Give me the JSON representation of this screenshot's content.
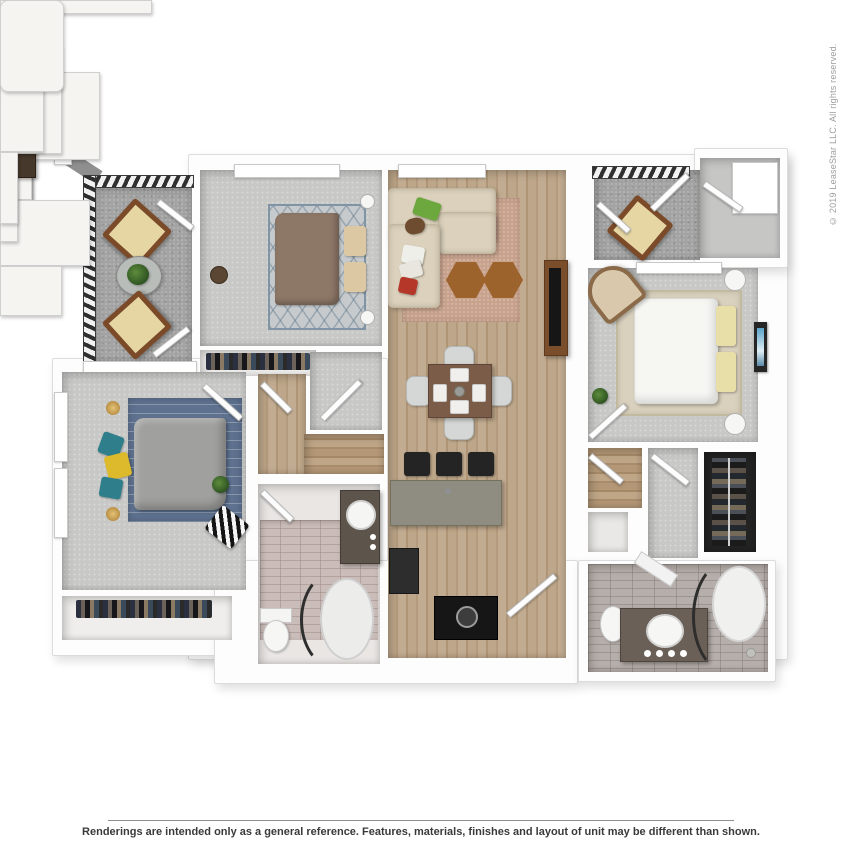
{
  "watermark": {
    "text": "© 2019 LeaseStar LLC. All rights reserved.",
    "color": "#9e9e9e"
  },
  "footer": {
    "disclaimer": "Renderings are intended only as a general reference. Features, materials, finishes and layout of unit may be different than shown.",
    "rule_color": "#8f8f8f",
    "text_color": "#3a3a3a"
  },
  "floorplan": {
    "type": "3d-top-down-apartment-floor-plan",
    "colors": {
      "wall": "#fdfdfd",
      "wall_edge": "#dcdcdc",
      "carpet": "#c8c9c7",
      "hardwood_living": "#b9a185",
      "hardwood_hall": "#ab9071",
      "balcony_concrete": "#a2a3a2",
      "bath_tile_pink": "#cabcb8",
      "bath_tile_gray": "#b6aeaa",
      "island_counter": "#8f8d81",
      "dark_wood_furniture": "#46382b",
      "sofa_beige": "#dbd1bc",
      "duvet_brown": "#8d7767",
      "duvet_gray": "#a0a09e",
      "duvet_white": "#f6f6f3",
      "rug_blue": "#5e7290",
      "rug_salmon": "#c8a28c",
      "accent_green": "#6ca83e",
      "accent_red": "#b5372a",
      "accent_teal": "#2e7f8b",
      "accent_yellow": "#ddb92c",
      "railing_dark": "#2f2f2f"
    },
    "rooms": [
      {
        "id": "balcony-left",
        "label": "balcony",
        "floor": "concrete",
        "furniture": [
          "lounge chair",
          "round glass table with plant",
          "lounge chair",
          "metal railing"
        ]
      },
      {
        "id": "bedroom-2",
        "label": "bedroom",
        "floor": "carpet",
        "furniture": [
          "dresser with round mirror",
          "bed with brown duvet",
          "two dark nightstands",
          "diamond-lattice rug",
          "window"
        ]
      },
      {
        "id": "bedroom-2-closet",
        "label": "closet",
        "floor": "hard",
        "furniture": [
          "hanging clothes"
        ]
      },
      {
        "id": "living-room",
        "label": "living room",
        "floor": "hardwood",
        "furniture": [
          "beige L-sectional sofa",
          "green/brown/white/red throw pillows",
          "two hexagonal wood side tables",
          "salmon area rug",
          "tall media console",
          "window"
        ]
      },
      {
        "id": "dining-area",
        "label": "dining area",
        "floor": "hardwood",
        "furniture": [
          "wood dining table with four place settings",
          "four gray chairs"
        ]
      },
      {
        "id": "kitchen",
        "label": "kitchen",
        "floor": "hardwood",
        "furniture": [
          "gray island with white sink",
          "three black bar stools",
          "white cabinet run",
          "dark range",
          "dark cooktop with pot"
        ]
      },
      {
        "id": "balcony-right",
        "label": "balcony",
        "floor": "concrete",
        "furniture": [
          "lounge chair",
          "metal railing"
        ]
      },
      {
        "id": "entry",
        "label": "entry",
        "floor": "concrete",
        "furniture": [
          "entry door"
        ]
      },
      {
        "id": "bedroom-3",
        "label": "bedroom",
        "floor": "carpet",
        "furniture": [
          "bed with white duvet",
          "two yellow pillows",
          "two dark nightstands with round lamps",
          "tan armchair",
          "white desk",
          "plant",
          "blue wall art",
          "beige rug",
          "window"
        ]
      },
      {
        "id": "laundry",
        "label": "laundry closet",
        "floor": "hardwood",
        "furniture": [
          "washer"
        ]
      },
      {
        "id": "hall-right",
        "label": "hall",
        "floor": "carpet",
        "furniture": []
      },
      {
        "id": "walk-in-closet",
        "label": "walk-in closet",
        "floor": "dark",
        "furniture": [
          "hanging clothes on rod"
        ]
      },
      {
        "id": "bathroom-2",
        "label": "bathroom",
        "floor": "gray tile",
        "furniture": [
          "toilet",
          "dark double vanity with round sink",
          "corner shower with curved glass",
          "towel"
        ]
      },
      {
        "id": "master-bedroom",
        "label": "master bedroom",
        "floor": "carpet",
        "furniture": [
          "bed with gray duvet",
          "teal and yellow pillows",
          "two dark nightstands with gold lamps",
          "blue striped rug",
          "white dresser",
          "chevron accent chair",
          "plant",
          "two windows"
        ]
      },
      {
        "id": "master-closet",
        "label": "closet",
        "floor": "hard",
        "furniture": [
          "hanging clothes",
          "shelf"
        ]
      },
      {
        "id": "hallway",
        "label": "hallway",
        "floor": "hardwood",
        "furniture": []
      },
      {
        "id": "bathroom-1",
        "label": "bathroom",
        "floor": "pink tile",
        "furniture": [
          "dark vanity with round sink",
          "oval bathtub with curved rod",
          "toilet"
        ]
      }
    ]
  }
}
